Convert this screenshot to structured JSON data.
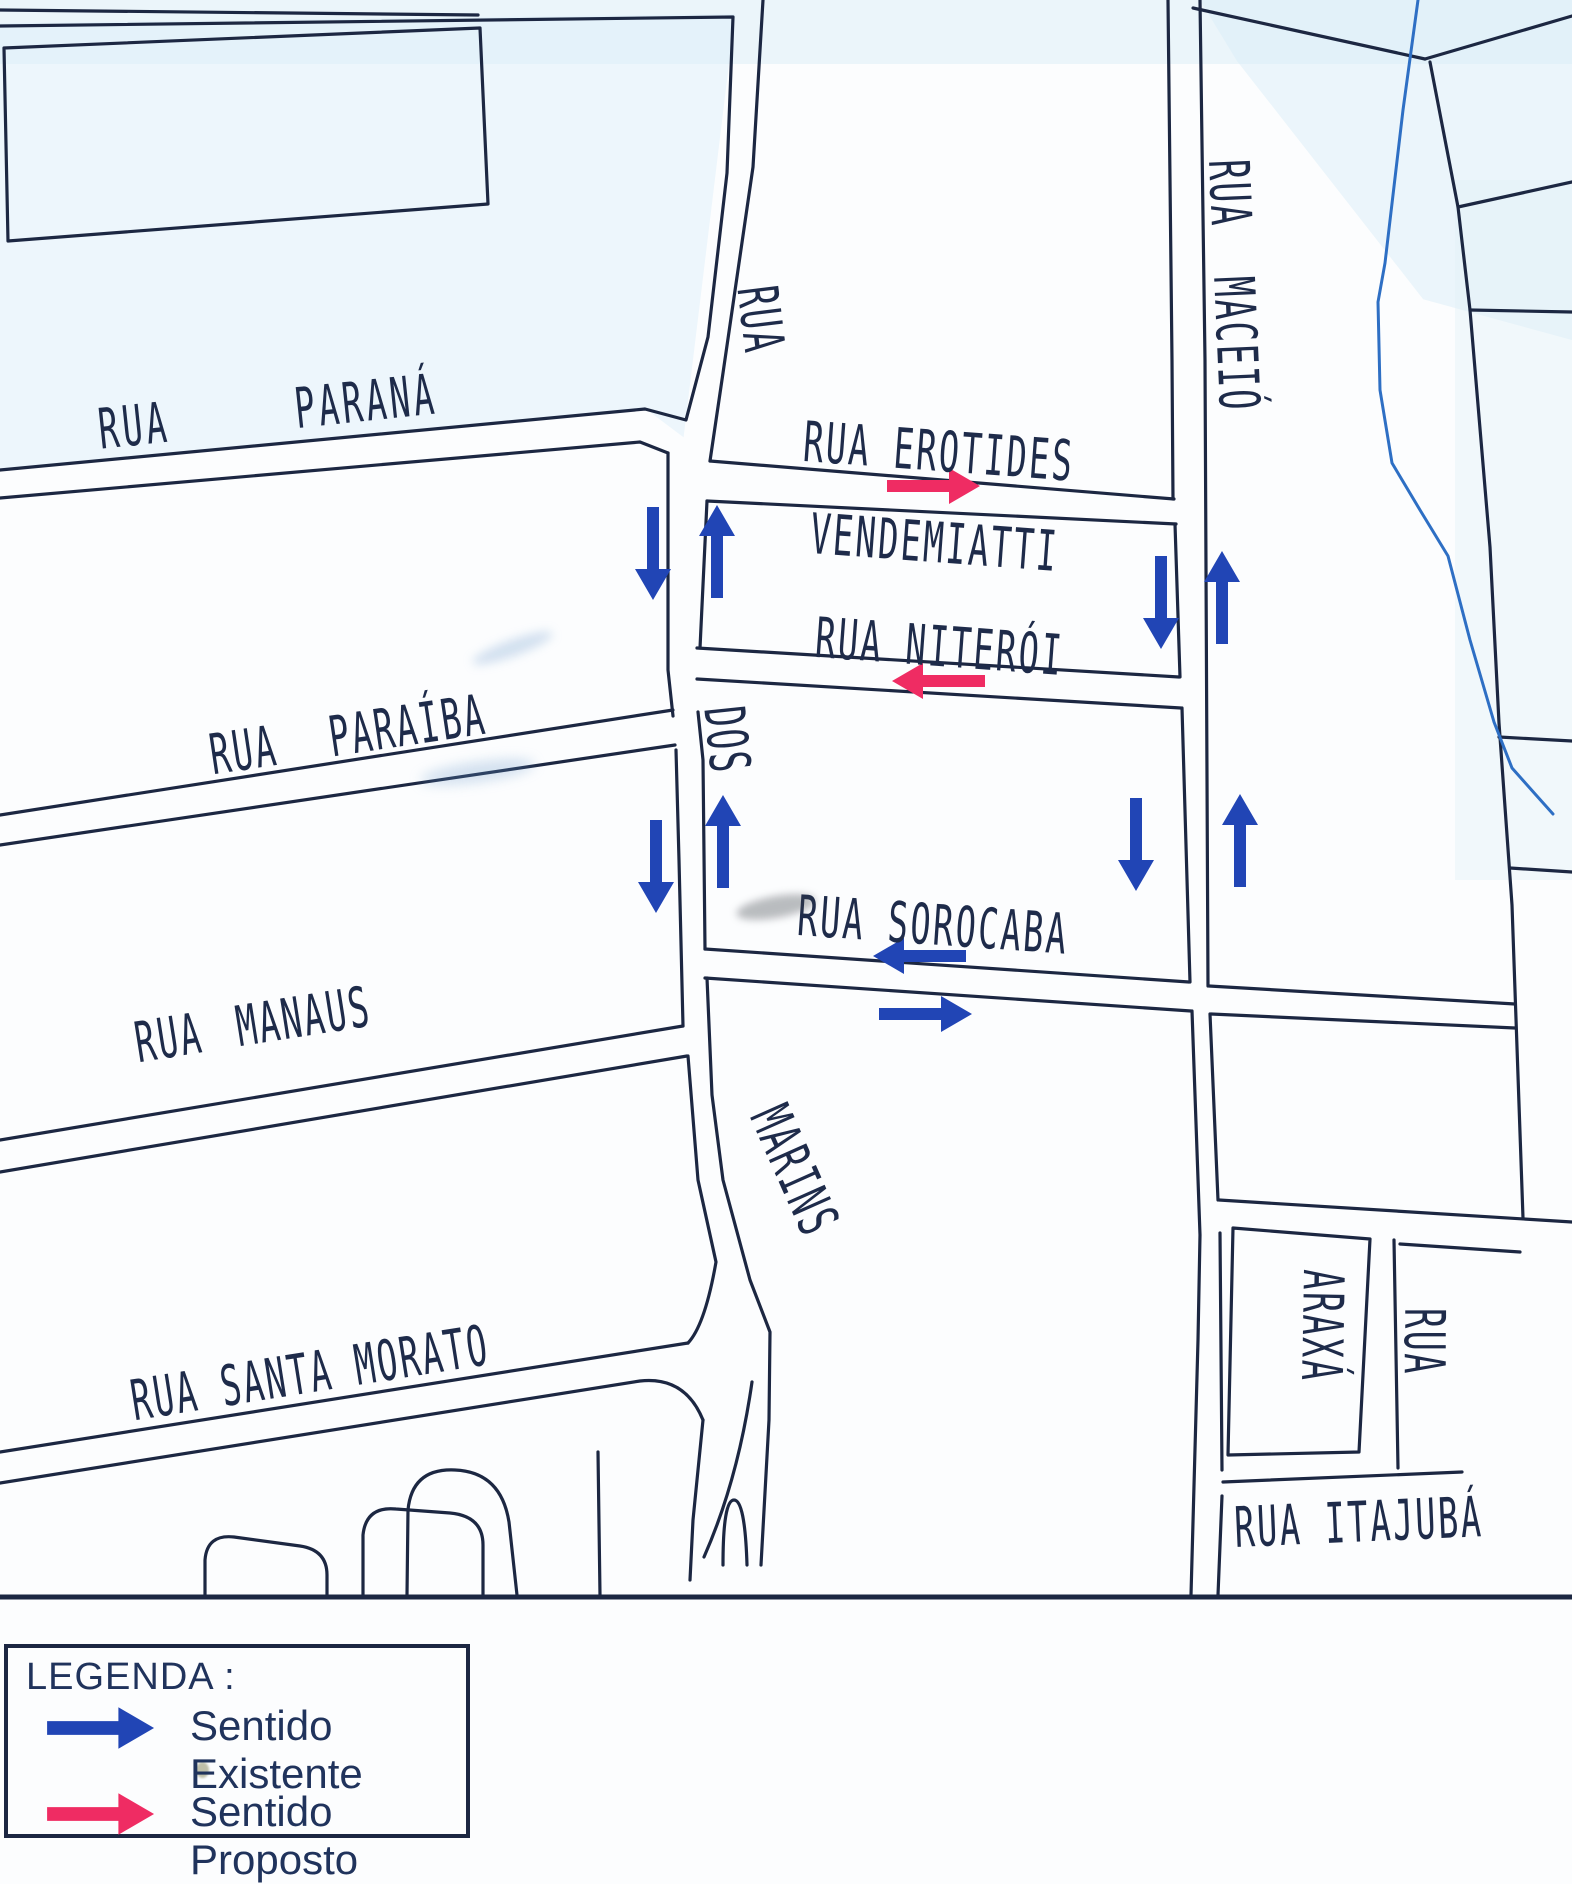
{
  "map": {
    "labels": {
      "parana": "RUA PARANÁ",
      "erotides": "RUA EROTIDES",
      "vendemiatti": "VENDEMIATTI",
      "niteroi": "RUA NITERÓI",
      "paraiba": "RUA PARAÍBA",
      "dos": "DOS",
      "sorocaba": "RUA SOROCABA",
      "manaus": "RUA MANAUS",
      "marins": "MARINS",
      "santa_morato": "RUA SANTA MORATO",
      "marins_rua": "RUA",
      "maceio": "RUA MACEIÓ",
      "araxa": "ARAXÁ",
      "rua_east": "RUA",
      "itajuba": "RUA ITAJUBÁ"
    },
    "arrows": {
      "existing_count": 12,
      "proposed_count": 2,
      "existing_meaning": "Sentido Existente",
      "proposed_meaning": "Sentido Proposto"
    }
  },
  "legend": {
    "title": "LEGENDA :",
    "items": [
      {
        "label": "Sentido Existente",
        "type": "existing"
      },
      {
        "label": "Sentido Proposto",
        "type": "proposed"
      }
    ]
  },
  "colors": {
    "existing": "#2145b5",
    "proposed": "#ef2c63",
    "line": "#1c2742",
    "river": "#2e6fc4",
    "label": "#1e2b4a",
    "legend_text": "#20335c"
  }
}
